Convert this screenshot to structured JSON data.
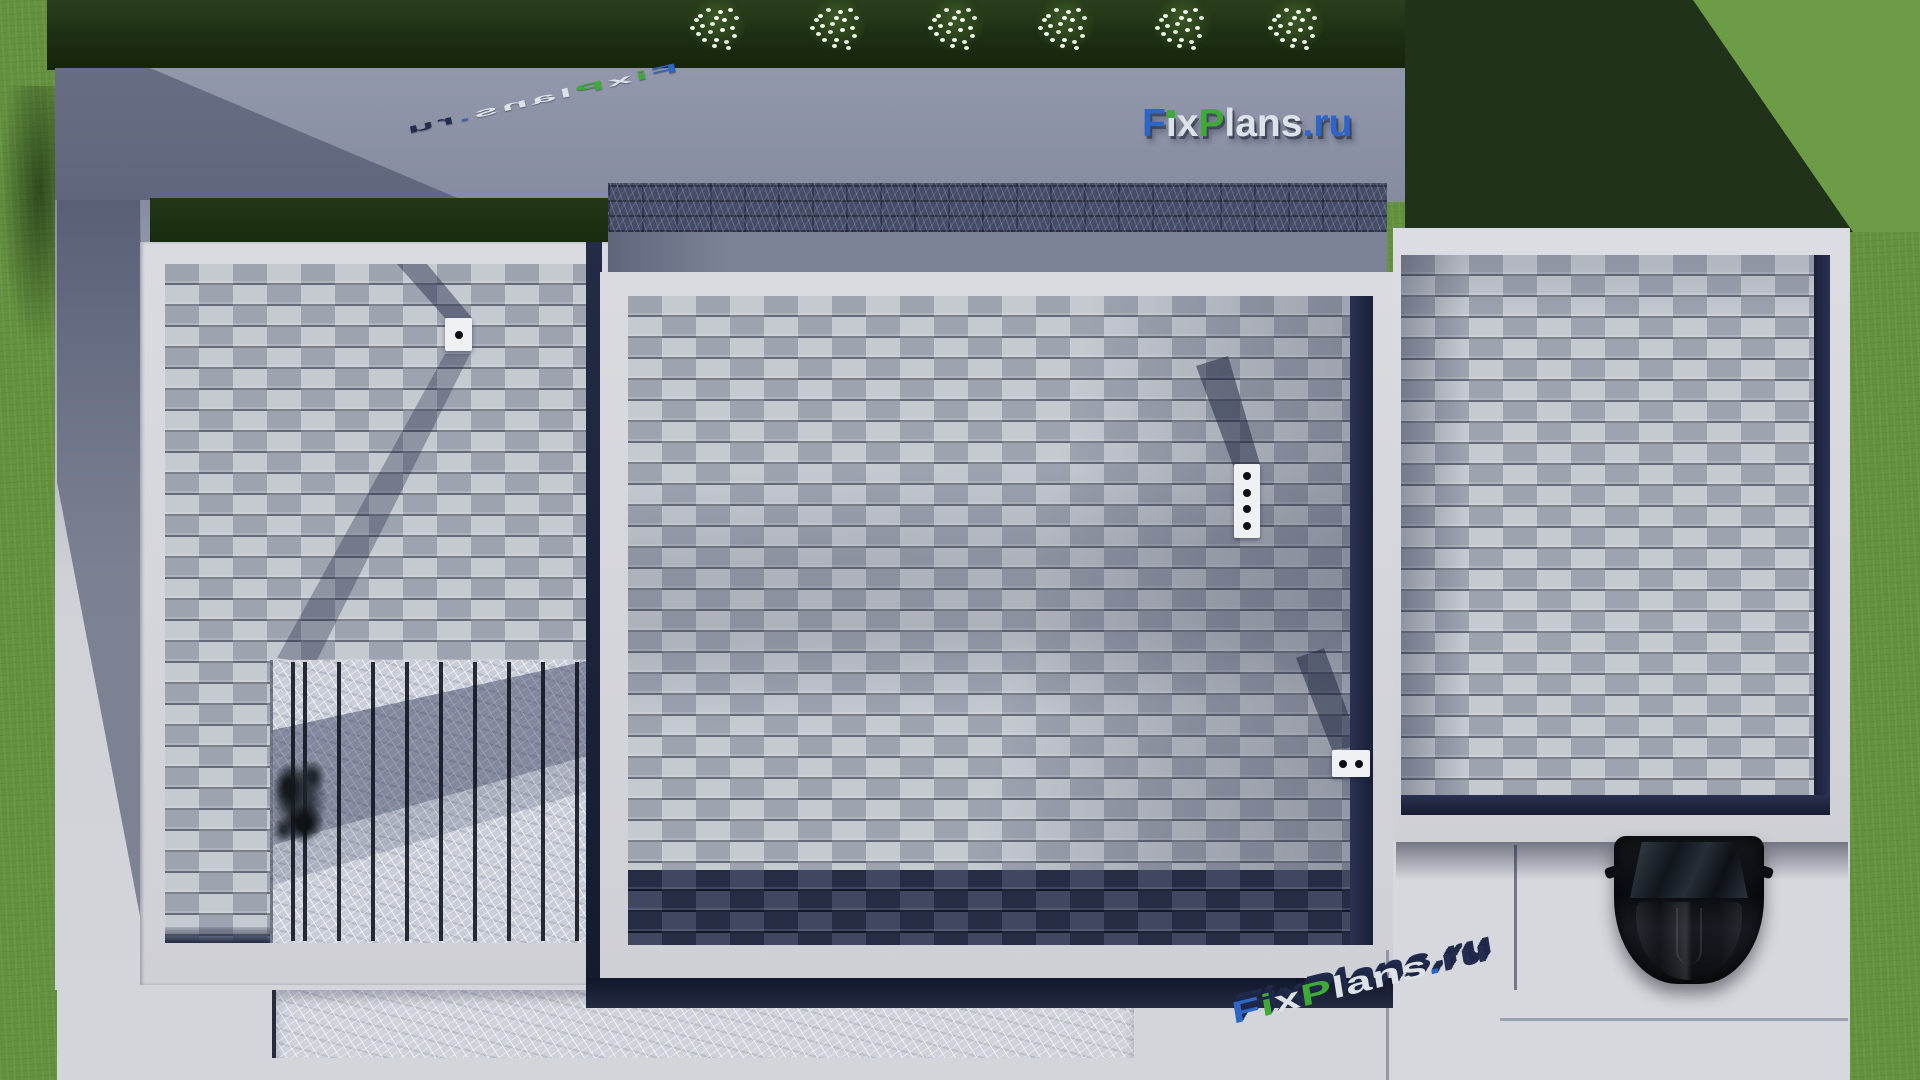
{
  "brand": {
    "text": "FixPlans.ru",
    "colors": {
      "blue": "#2e66c8",
      "green": "#3faa35",
      "silver": "#dde1e8",
      "navy": "#242d50"
    },
    "segments": [
      {
        "ch": "F",
        "color": "blue"
      },
      {
        "ch": "i",
        "color": "silver",
        "dot": "green"
      },
      {
        "ch": "x",
        "color": "silver"
      },
      {
        "ch": "P",
        "color": "green"
      },
      {
        "ch": "lans",
        "color": "silver"
      },
      {
        "ch": ".",
        "color": "blue"
      },
      {
        "ch": "ru",
        "color": "blue"
      }
    ],
    "segments_ground": [
      {
        "ch": "F",
        "color": "blue"
      },
      {
        "ch": "i",
        "color": "green"
      },
      {
        "ch": "x",
        "color": "silver"
      },
      {
        "ch": "P",
        "color": "green"
      },
      {
        "ch": "lans",
        "color": "silver"
      },
      {
        "ch": ".",
        "color": "blue"
      },
      {
        "ch": "ru",
        "color": "navy"
      }
    ]
  },
  "scene": {
    "type": "top-down 3D architectural render of a flat-roof house",
    "flower_bush_count": 6,
    "roof_vents": [
      {
        "location": "left-roof",
        "dots": 1
      },
      {
        "location": "central-roof",
        "dots": 4
      },
      {
        "location": "central-roof-right",
        "dots": 2
      }
    ],
    "car": {
      "color": "black",
      "location": "driveway-bottom-right"
    },
    "palette": {
      "lawn": "#63913e",
      "lawn_shadow": "#20331a",
      "hedge": "#1c2e13",
      "concrete_path": "#8e94a7",
      "roof_shingle_light": "#adb2bc",
      "roof_shingle_dark": "#394059",
      "parapet_white": "#d6d7dc",
      "walkway_stone": "#454c66",
      "patio_marble": "#c9cdd8",
      "ground_concrete": "#d3d5da"
    }
  }
}
